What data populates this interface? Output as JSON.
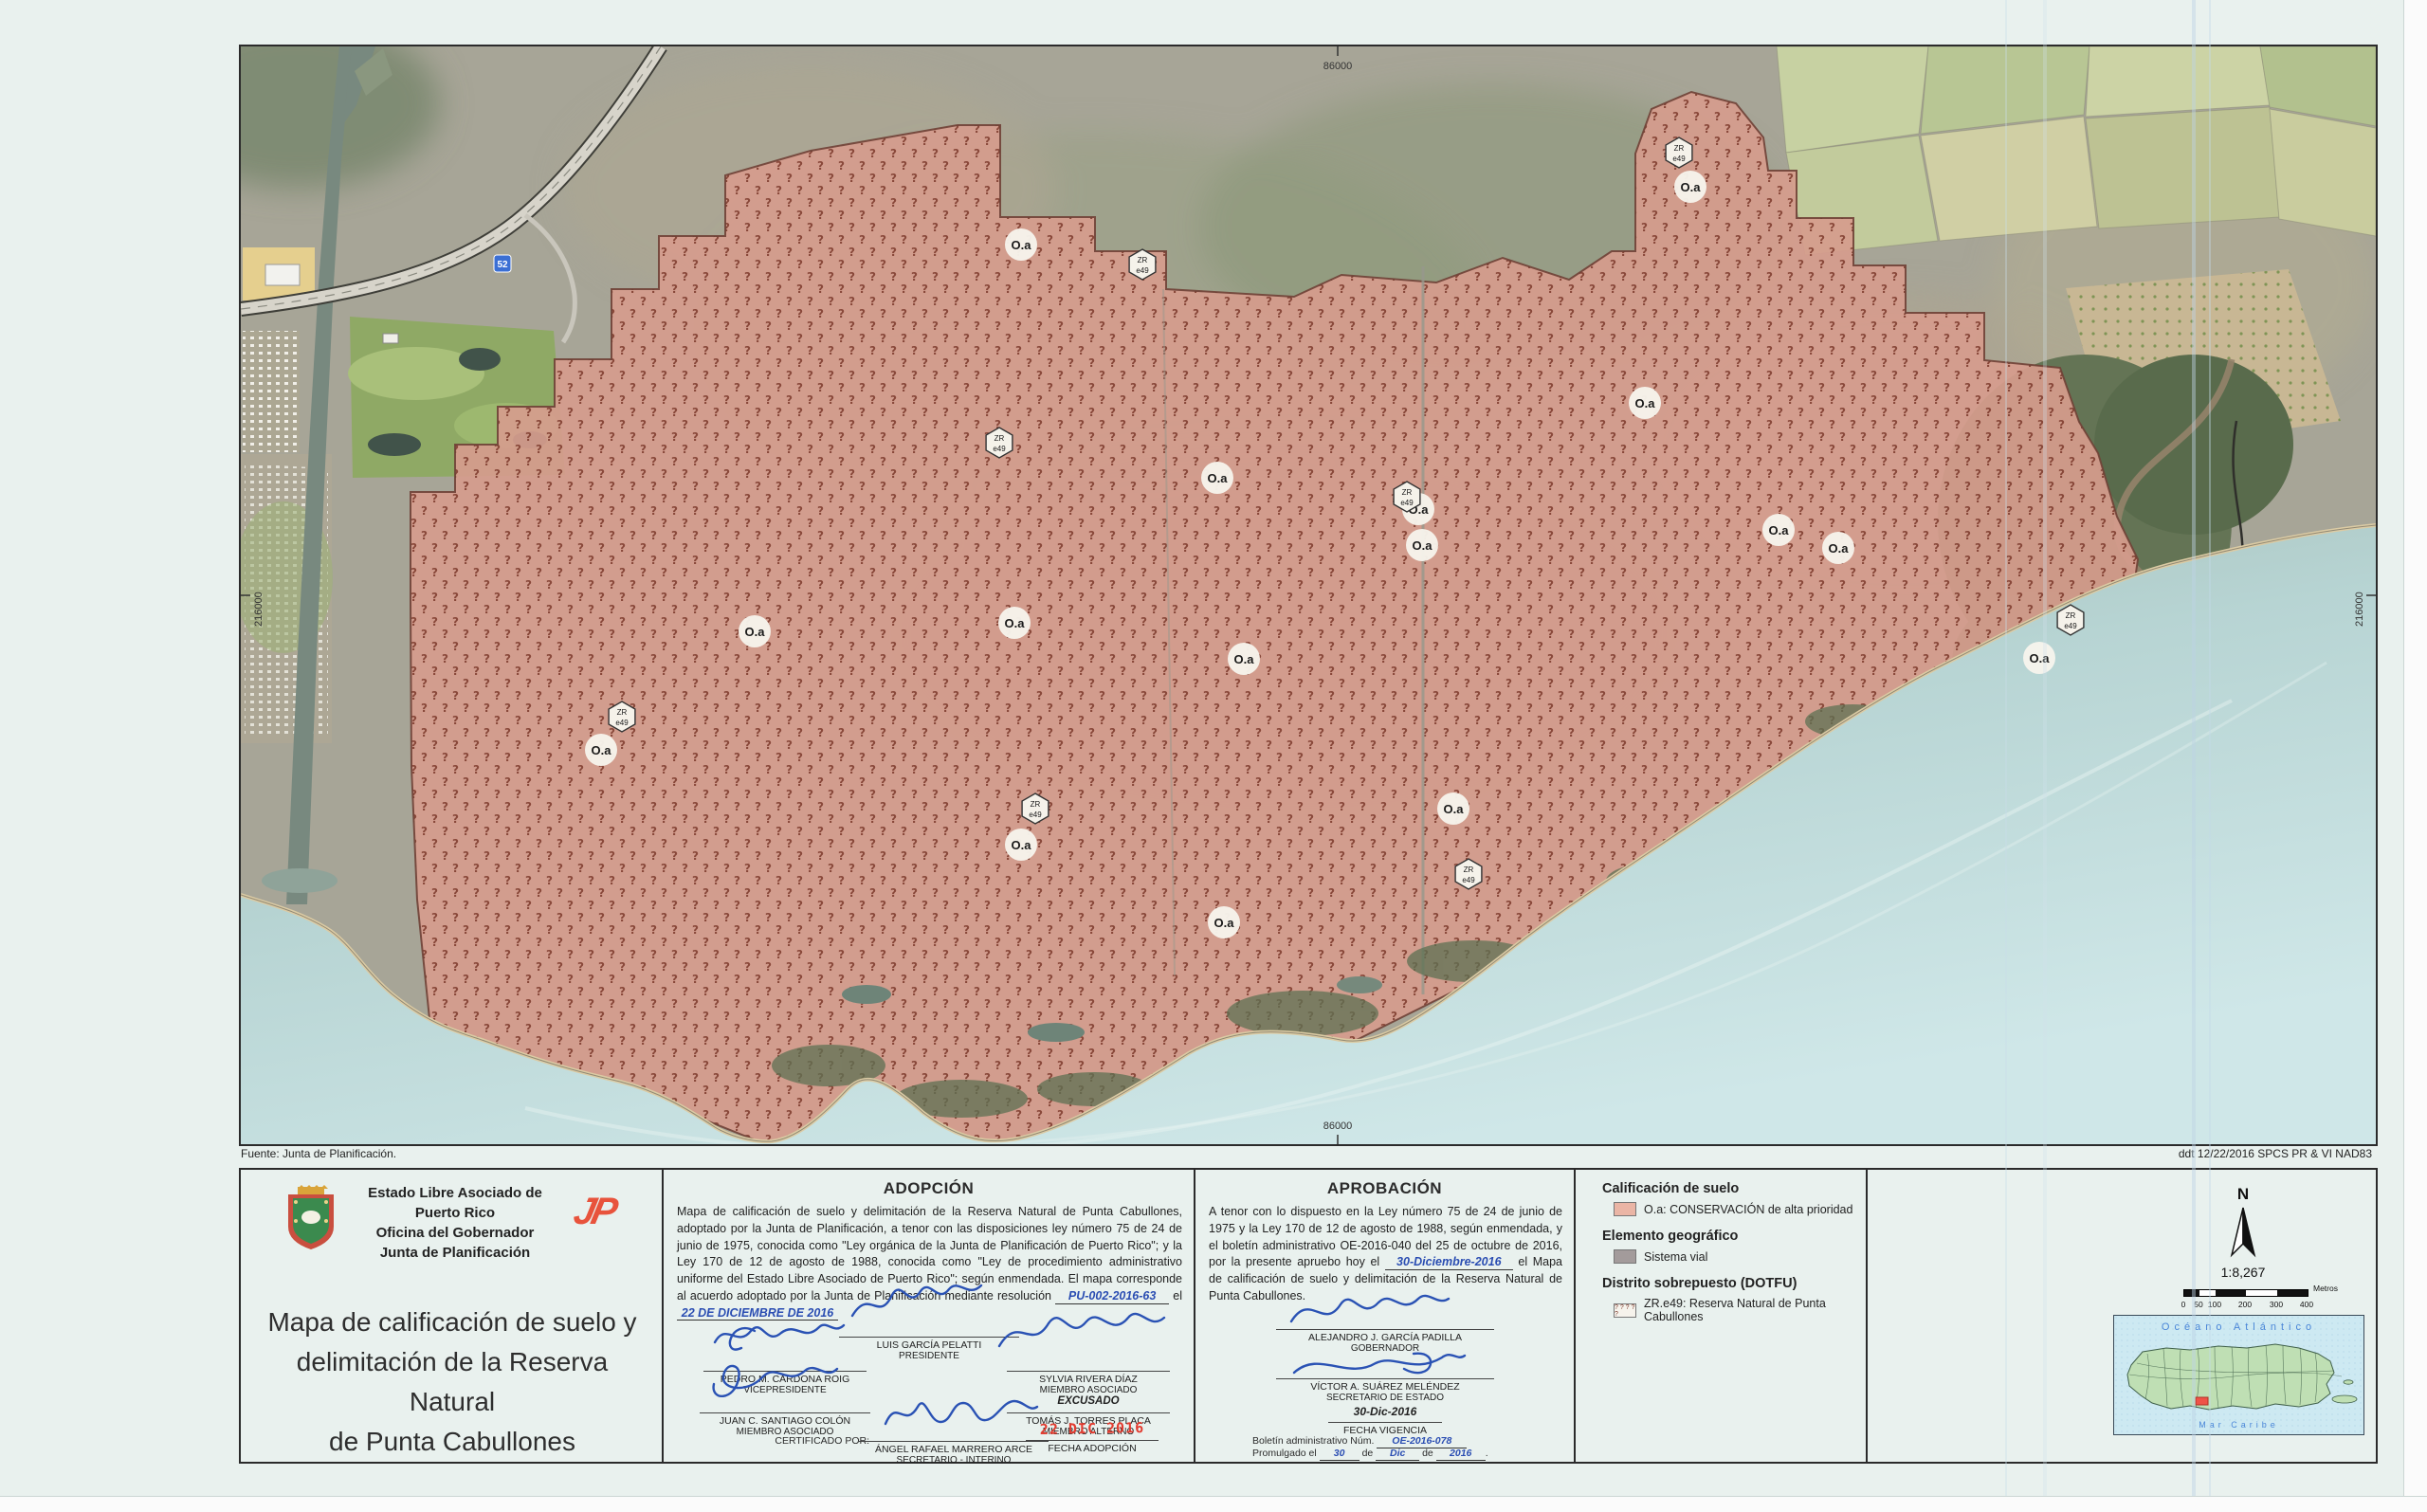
{
  "colors": {
    "accent_red": "#e8533c",
    "stamp_red": "#e23c30",
    "hand_blue": "#2a4db2",
    "sig_blue": "#2a52b4",
    "reserve_fill": "#d69c8d",
    "reserve_glyph": "#7c3a2c",
    "legend_salmon": "#eab5a5",
    "legend_gray": "#a39b9b",
    "water": "#bcd8da",
    "paper": "#e9f1ee"
  },
  "sheet_notes": {
    "source": "Fuente: Junta de Planificación.",
    "right_note": "ddt 12/22/2016   SPCS PR & VI NAD83"
  },
  "map": {
    "grid_labels": {
      "top": "86000",
      "bottom": "86000",
      "left": "216000",
      "right": "216000"
    },
    "area_label": "O.a",
    "overlay_badge": {
      "line1": "ZR",
      "line2": "e49"
    },
    "route_shield": "52",
    "oa_badges": [
      [
        823,
        209
      ],
      [
        1529,
        148
      ],
      [
        1481,
        376
      ],
      [
        1242,
        488
      ],
      [
        1246,
        526
      ],
      [
        1030,
        455
      ],
      [
        1622,
        510
      ],
      [
        1685,
        529
      ],
      [
        542,
        617
      ],
      [
        816,
        608
      ],
      [
        1058,
        646
      ],
      [
        1897,
        645
      ],
      [
        380,
        742
      ],
      [
        823,
        842
      ],
      [
        1279,
        804
      ],
      [
        1037,
        924
      ]
    ],
    "zr_badges": [
      [
        951,
        230
      ],
      [
        1517,
        112
      ],
      [
        1230,
        475
      ],
      [
        800,
        418
      ],
      [
        402,
        707
      ],
      [
        838,
        804
      ],
      [
        1295,
        873
      ],
      [
        1930,
        605
      ]
    ]
  },
  "title_block": {
    "agency_lines": [
      "Estado Libre Asociado de Puerto Rico",
      "Oficina del Gobernador",
      "Junta de Planificación"
    ],
    "logo_text": "JP",
    "title_lines": [
      "Mapa de calificación de suelo y",
      "delimitación de la Reserva Natural",
      "de Punta Cabullones"
    ]
  },
  "adopcion": {
    "header": "ADOPCIÓN",
    "body": "Mapa de calificación de suelo y delimitación de la Reserva Natural de Punta Cabullones, adoptado por la Junta de Planificación, a tenor con las disposiciones ley número 75 de 24 de junio de 1975, conocida como \"Ley orgánica de la Junta de Planificación de Puerto Rico\"; y la Ley 170 de 12 de agosto de 1988, conocida como \"Ley de procedimiento administrativo uniforme del Estado Libre Asociado de Puerto Rico\"; según enmendada. El mapa corresponde al acuerdo adoptado por la Junta de Planificación mediante",
    "resolution_label": "resolución",
    "resolution_value": "PU-002-2016-63",
    "el_label": "el",
    "resolution_date": "22 DE DICIEMBRE DE 2016",
    "sign_pedro_name": "PEDRO M. CARDONA ROIG",
    "sign_pedro_title": "VICEPRESIDENTE",
    "sign_luis_name": "LUIS GARCÍA PELATTI",
    "sign_luis_title": "PRESIDENTE",
    "sign_sylvia_name": "SYLVIA RIVERA DÍAZ",
    "sign_sylvia_title": "MIEMBRO ASOCIADO",
    "sign_juan_name": "JUAN C. SANTIAGO COLÓN",
    "sign_juan_title": "MIEMBRO ASOCIADO",
    "excusado_note": "EXCUSADO",
    "sign_tomas_name": "TOMÁS J. TORRES PLACA",
    "sign_tomas_title": "MIEMBRO ALTERNO",
    "certified_by_label": "CERTIFICADO POR:",
    "sign_angel_name": "ÁNGEL RAFAEL MARRERO ARCE",
    "sign_angel_title": "SECRETARIO - INTERINO",
    "stamp_date": "22 DIC 2016",
    "stamp_caption": "FECHA ADOPCIÓN"
  },
  "aprobacion": {
    "header": "APROBACIÓN",
    "body_before": "A tenor con lo dispuesto en la Ley número 75 de 24 de junio de 1975 y la Ley 170 de 12 de agosto de 1988, según enmendada, y el boletín administrativo OE-2016-040 del 25 de octubre de 2016, por la presente apruebo hoy el",
    "approval_date_hand": "30-Diciembre-2016",
    "body_after": "el Mapa de calificación de suelo y delimitación de la Reserva Natural de Punta Cabullones.",
    "governor_name": "ALEJANDRO J. GARCÍA PADILLA",
    "governor_title": "GOBERNADOR",
    "secretary_name": "VÍCTOR A. SUÁREZ MELÉNDEZ",
    "secretary_title": "SECRETARIO DE ESTADO",
    "vigencia_date": "30-Dic-2016",
    "vigencia_label": "FECHA VIGENCIA",
    "boletin_label": "Boletín administrativo Núm.",
    "boletin_value": "OE-2016-078",
    "promulgado_label": "Promulgado el",
    "promulgado_day": "30",
    "de1": "de",
    "promulgado_month": "Dic",
    "de2": "de",
    "promulgado_year": "2016"
  },
  "legend": {
    "sections": [
      {
        "header": "Calificación de suelo",
        "item_label": "O.a:  CONSERVACIÓN de alta prioridad"
      },
      {
        "header": "Elemento geográfico",
        "item_label": "Sistema vial"
      },
      {
        "header": "Distrito sobrepuesto (DOTFU)",
        "item_label": "ZR.e49:  Reserva Natural de Punta Cabullones"
      }
    ]
  },
  "map_tools": {
    "north_label": "N",
    "scale_text": "1:8,267",
    "scale_bar_ticks": [
      "0",
      "50",
      "100",
      "200",
      "300",
      "400"
    ],
    "scale_bar_unit": "Metros",
    "locator": {
      "ocean_label": "Océano Atlántico",
      "sea_label": "Mar Caribe"
    }
  }
}
